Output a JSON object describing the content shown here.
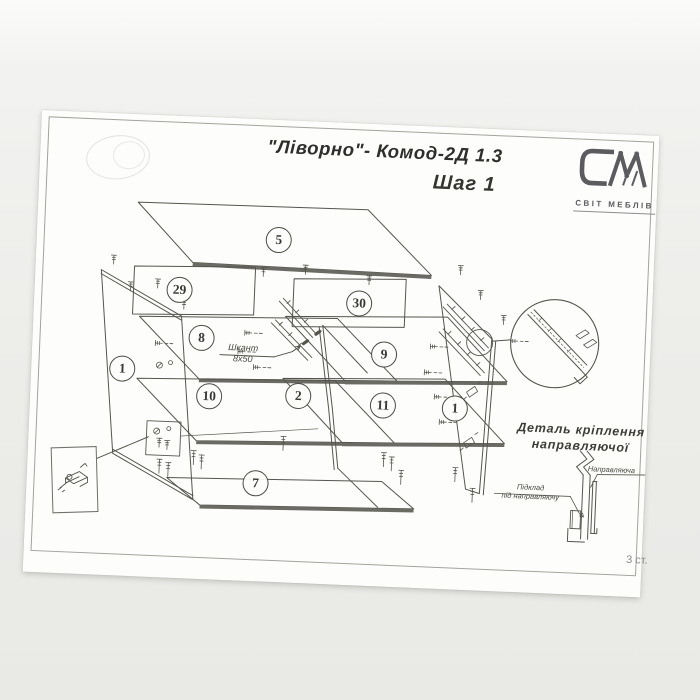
{
  "document": {
    "title": "\"Ліворно\"- Комод-2Д 1.3",
    "step": "Шаг 1",
    "page_note": "3 ст."
  },
  "logo": {
    "monogram": "СМ",
    "company": "СВІТ МЕБЛІВ"
  },
  "parts": [
    {
      "num": "5"
    },
    {
      "num": "29"
    },
    {
      "num": "30"
    },
    {
      "num": "8"
    },
    {
      "num": "9"
    },
    {
      "num": "1"
    },
    {
      "num": "10"
    },
    {
      "num": "2"
    },
    {
      "num": "11"
    },
    {
      "num": "1"
    },
    {
      "num": "7"
    }
  ],
  "labels": {
    "dowel_name": "Шкант",
    "dowel_size": "8х50",
    "detail_caption_line1": "Деталь кріплення",
    "detail_caption_line2": "направляючої",
    "rail_label": "Направляюча",
    "pad_label_line1": "Підклад",
    "pad_label_line2": "під направляючу"
  }
}
